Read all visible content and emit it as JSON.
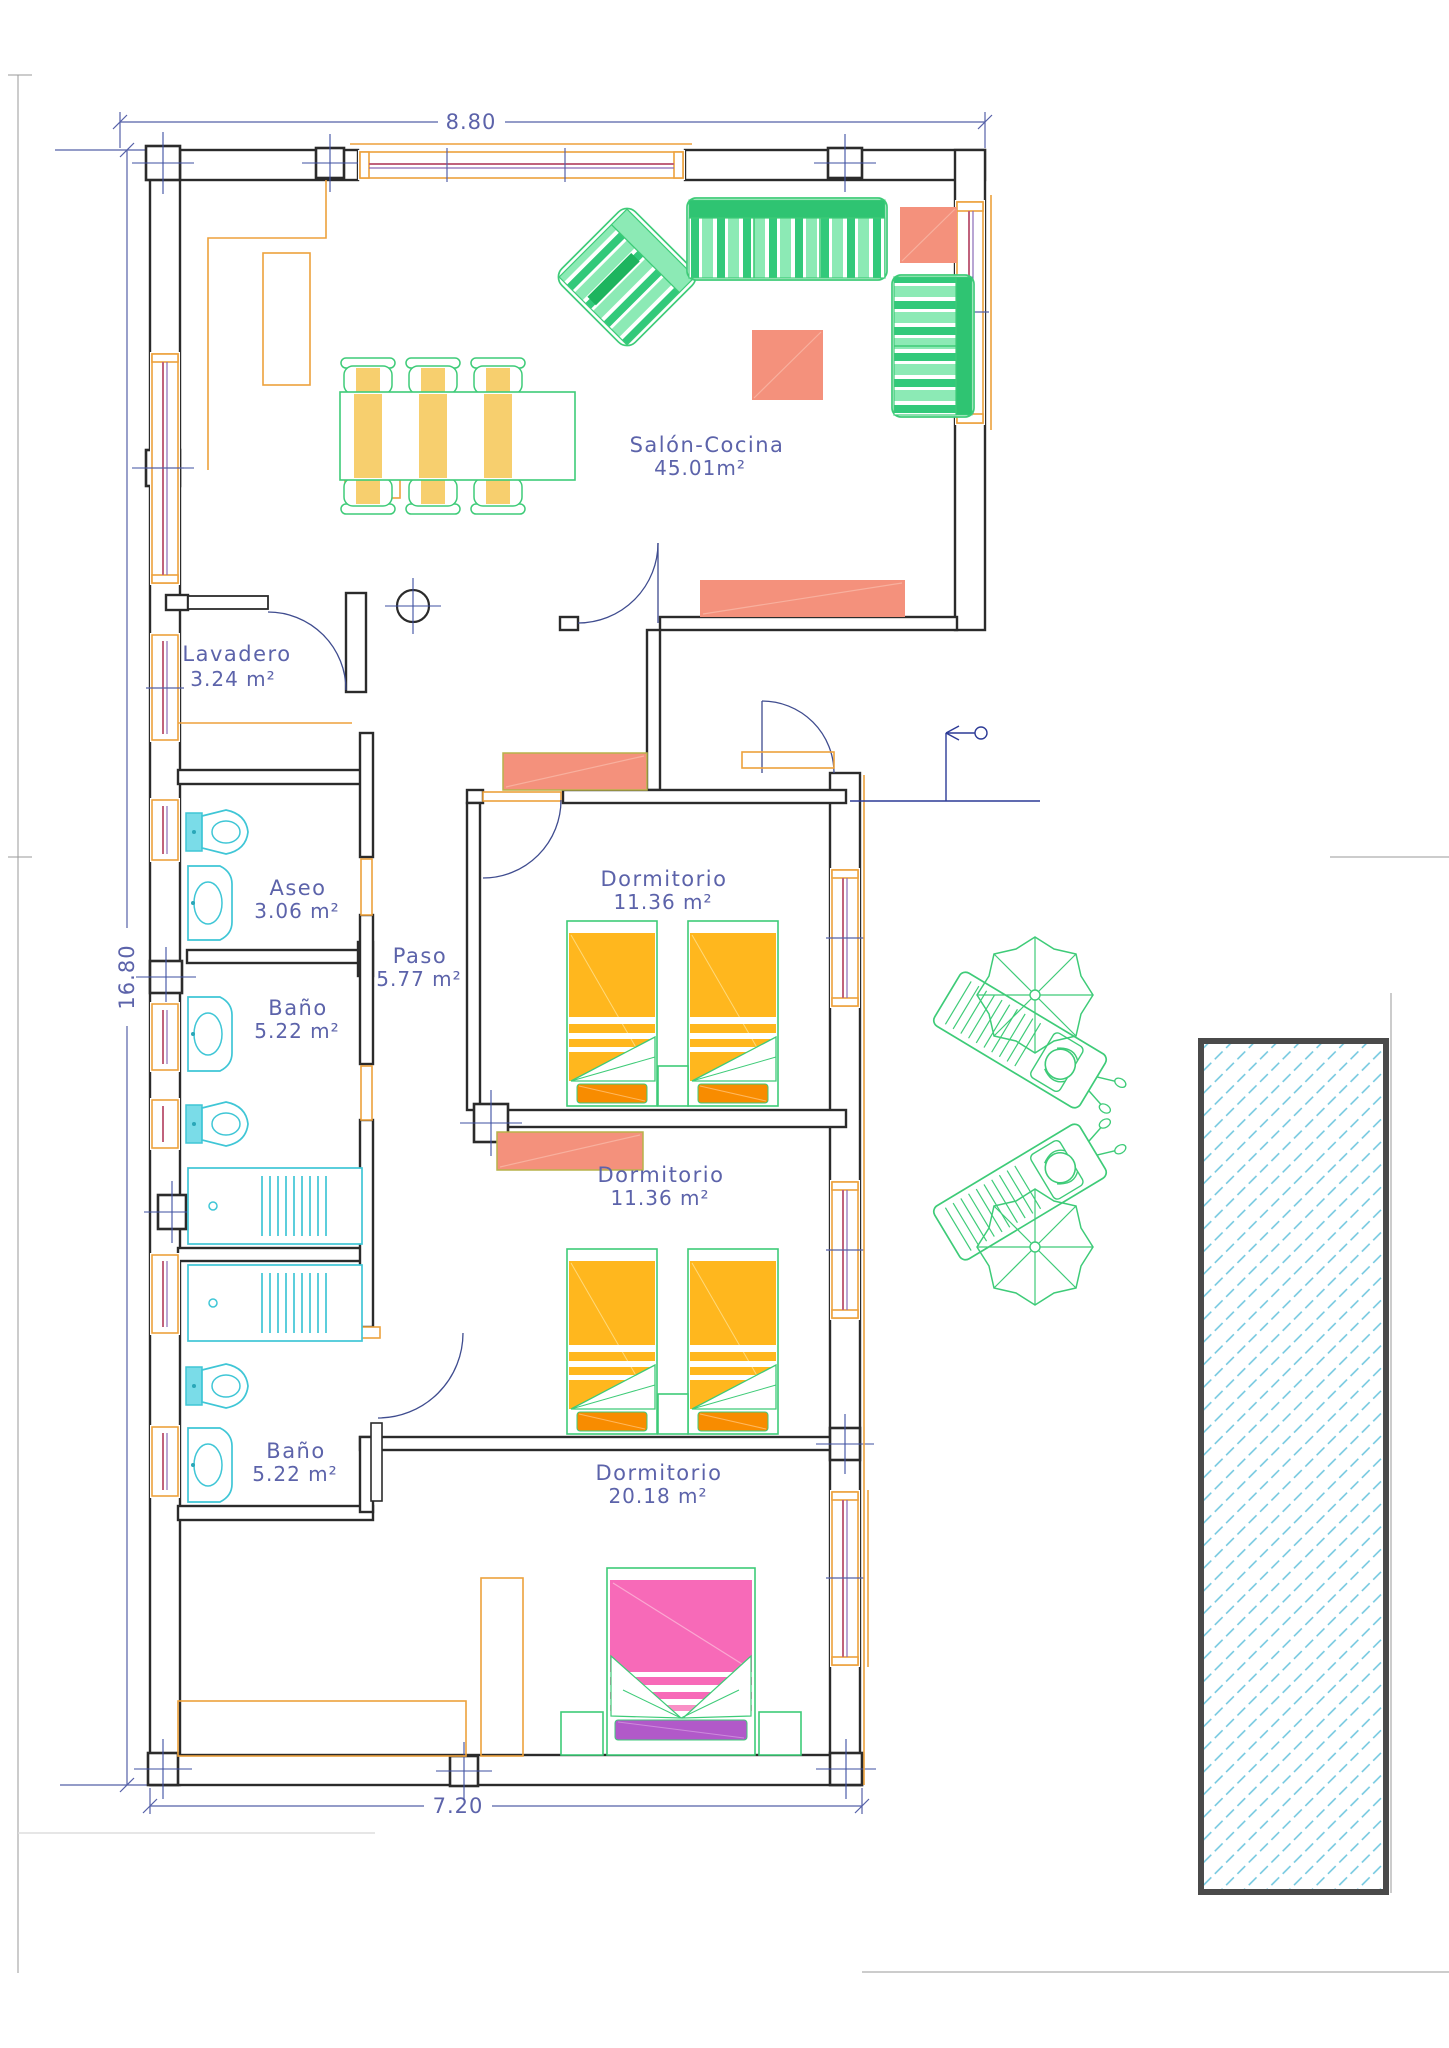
{
  "document": {
    "type": "architectural-floor-plan",
    "style": "CAD colored plan with pool"
  },
  "dims": {
    "top": "8.80",
    "left": "16.80",
    "bottom": "7.20"
  },
  "rooms": [
    {
      "name": "Salón-Cocina",
      "area": "45.01m²"
    },
    {
      "name": "Lavadero",
      "area": "3.24 m²"
    },
    {
      "name": "Aseo",
      "area": "3.06 m²"
    },
    {
      "name": "Paso",
      "area": "5.77 m²"
    },
    {
      "name": "Baño",
      "area": "5.22 m²"
    },
    {
      "name": "Dormitorio",
      "area": "11.36 m²"
    },
    {
      "name": "Dormitorio",
      "area": "11.36 m²"
    },
    {
      "name": "Baño",
      "area": "5.22 m²"
    },
    {
      "name": "Dormitorio",
      "area": "20.18 m²"
    }
  ],
  "symbols": [
    "north-entry-arrow",
    "column-cross-markers",
    "door-swing-arcs",
    "dining-table-6-chairs",
    "sofa-3-seat",
    "sofa-2-seat",
    "armchair",
    "coffee-table",
    "side-tables",
    "kitchen-island",
    "kitchen-counter",
    "twin-bed-x4",
    "double-bed",
    "nightstands",
    "wardrobe",
    "toilet-x3",
    "washbasin-x3",
    "shower-tray-x2",
    "sun-lounger-with-person-x2",
    "parasol-x2",
    "swimming-pool-hatched"
  ],
  "colors": {
    "walls": "#2b2b2b",
    "annotation_blue": "#5c63aa",
    "carpentry_orange": "#eda13c",
    "glazing_pink": "#c0627c",
    "furniture_green": "#3ecb78",
    "sofa_green_fill": "#8ceab5",
    "table_yellow": "#f7cf6e",
    "bed_amber": "#ffb71e",
    "pillow_orange": "#f88c00",
    "bed_pink": "#f76ab8",
    "pillow_purple": "#b159c9",
    "salmon": "#f4917c",
    "sanitary_cyan": "#3fc6d6",
    "pool_hatch_cyan": "#6cc5de"
  }
}
